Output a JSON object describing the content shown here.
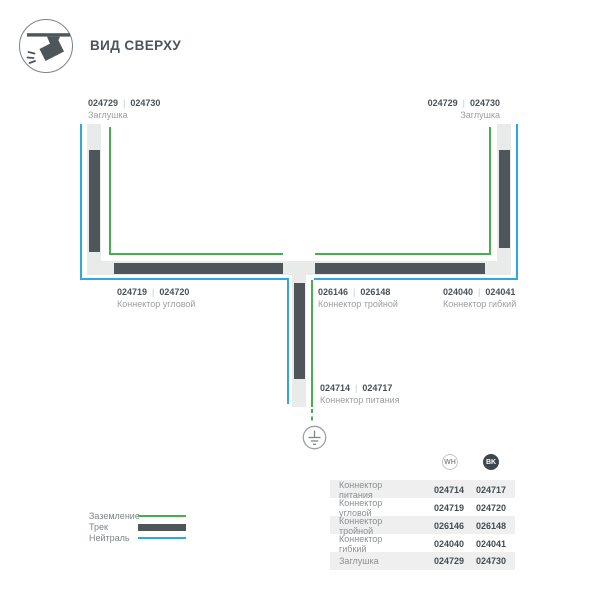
{
  "header": {
    "title": "ВИД СВЕРХУ",
    "icon": "track-spotlight-top-view-icon"
  },
  "diagram": {
    "separator": "|",
    "cap_left": {
      "wh": "024729",
      "bk": "024730",
      "name": "Заглушка"
    },
    "cap_right": {
      "wh": "024729",
      "bk": "024730",
      "name": "Заглушка"
    },
    "corner": {
      "wh": "024719",
      "bk": "024720",
      "name": "Коннектор угловой"
    },
    "triple": {
      "wh": "026146",
      "bk": "026148",
      "name": "Коннектор тройной"
    },
    "flexible": {
      "wh": "024040",
      "bk": "024041",
      "name": "Коннектор гибкий"
    },
    "power": {
      "wh": "024714",
      "bk": "024717",
      "name": "Коннектор питания"
    },
    "ground_icon": "earth-ground-symbol"
  },
  "legend": {
    "items": [
      {
        "label": "Заземление",
        "type": "ground",
        "color": "#45B04E"
      },
      {
        "label": "Трек",
        "type": "track",
        "color": "#4E565A"
      },
      {
        "label": "Нейтраль",
        "type": "neutral",
        "color": "#2FA8DF"
      }
    ]
  },
  "table": {
    "columns": [
      {
        "id": "wh",
        "label": "WH"
      },
      {
        "id": "bk",
        "label": "BK"
      }
    ],
    "rows": [
      {
        "name": "Коннектор питания",
        "wh": "024714",
        "bk": "024717"
      },
      {
        "name": "Коннектор угловой",
        "wh": "024719",
        "bk": "024720"
      },
      {
        "name": "Коннектор тройной",
        "wh": "026146",
        "bk": "026148"
      },
      {
        "name": "Коннектор гибкий",
        "wh": "024040",
        "bk": "024041"
      },
      {
        "name": "Заглушка",
        "wh": "024729",
        "bk": "024730"
      }
    ]
  },
  "colors": {
    "track_dark": "#4E565A",
    "track_light": "#E9EAEA",
    "neutral_blue": "#2FA8DF",
    "ground_green": "#45B04E",
    "text_dark": "#4A5257",
    "text_gray": "#9B9E9F",
    "row_stripe": "#EFEFEF"
  }
}
